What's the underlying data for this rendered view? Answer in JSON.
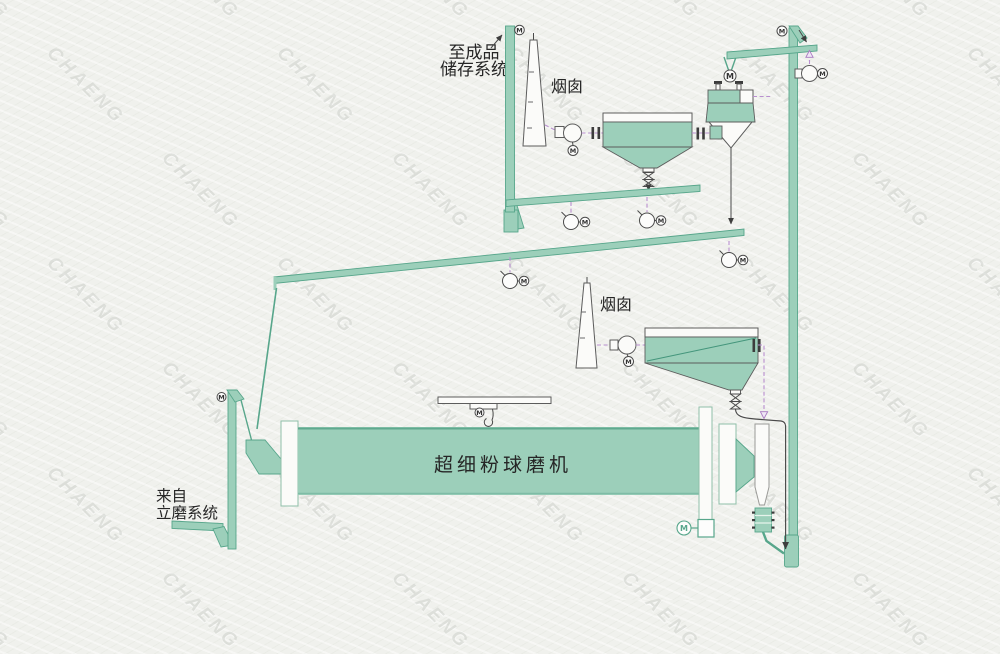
{
  "labels": {
    "to_storage_line1": "至成品",
    "to_storage_line2": "储存系统",
    "chimney_1": "烟囱",
    "chimney_2": "烟囱",
    "ball_mill": "超细粉球磨机",
    "from_mill_line1": "来自",
    "from_mill_line2": "立磨系统",
    "motor_letter": "M"
  },
  "watermark": {
    "text": "CHAENG"
  },
  "colors": {
    "background": "#f0f1ed",
    "equipment_fill": "#9ccfba",
    "equipment_edge": "#57a68b",
    "outline": "#555555",
    "airflow_dash": "#b98fd0",
    "text": "#262626",
    "watermark_text": "#cbcec9"
  }
}
